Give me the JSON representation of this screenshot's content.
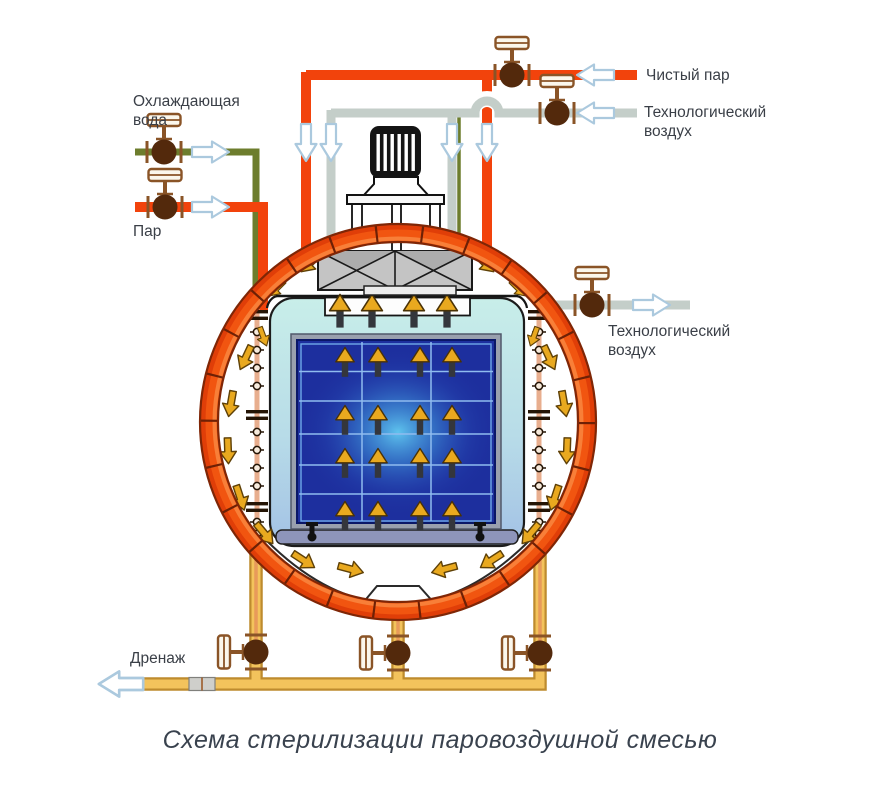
{
  "caption": "Схема стерилизации паровоздушной смесью",
  "labels": {
    "cooling_water_1": "Охлаждающая",
    "cooling_water_2": "вода",
    "steam": "Пар",
    "clean_steam": "Чистый пар",
    "process_air_1": "Технологический",
    "process_air_2": "воздух",
    "drain": "Дренаж"
  },
  "colors": {
    "steam_pipe": "#F2430C",
    "process_air_pipe": "#C4CEC9",
    "cooling_water_pipe": "#6D7D2D",
    "drain_pipe": "#F3C35C",
    "drain_pipe_border": "#BE8B2E",
    "vessel_ring": "#F15510",
    "valve_body": "#53290C",
    "valve_handle": "#8A5427",
    "flow_arrow_outline": "#ABC9DE",
    "gold_arrow": "#E9A91F",
    "chamber_shell": "#C6ECE8",
    "load_box": "#1D2F9E",
    "load_glow": "#5FC8EF",
    "sparger": "#E8AE8E"
  }
}
